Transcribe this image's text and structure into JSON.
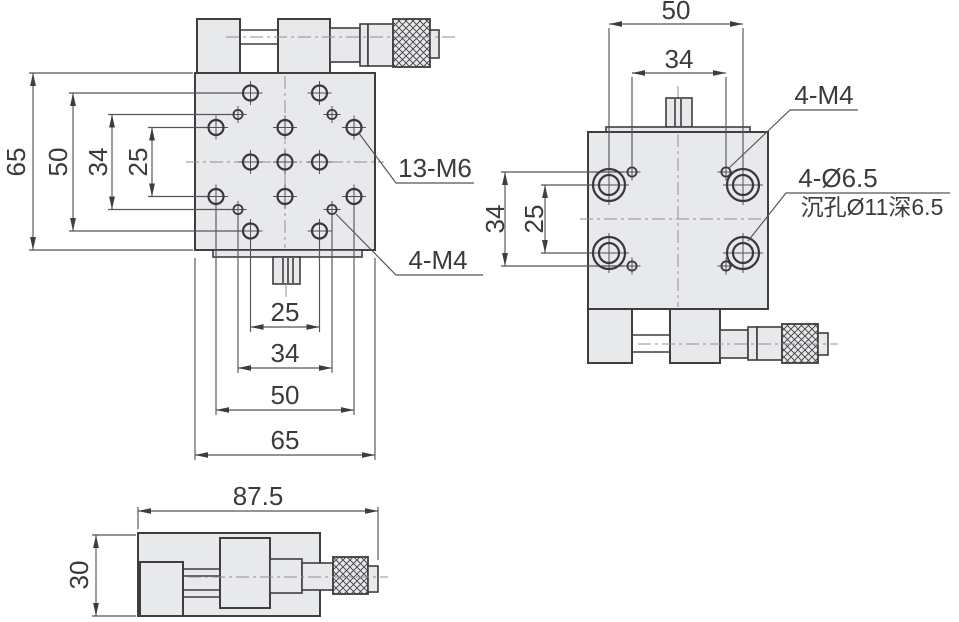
{
  "title": "XY translation stage dimensional drawing",
  "colors": {
    "part_fill": "#e8e9ea",
    "object_line": "#3e3e40",
    "dimension_line": "#55555a",
    "center_line": "#909093",
    "text": "#3b3b3d",
    "background": "#ffffff"
  },
  "views": {
    "top_view": {
      "dim_left": {
        "d65": "65",
        "d50": "50",
        "d34": "34",
        "d25": "25"
      },
      "dim_bottom": {
        "d25": "25",
        "d34": "34",
        "d50": "50",
        "d65": "65"
      },
      "leader_m6": "13-M6",
      "leader_m4": "4-M4"
    },
    "bottom_view": {
      "dim_top": {
        "d50": "50",
        "d34": "34"
      },
      "dim_left": {
        "d34": "34",
        "d25": "25"
      },
      "leader_m4": "4-M4",
      "leader_counterbore_line1": "4-Ø6.5",
      "leader_counterbore_line2": "沉孔Ø11深6.5"
    },
    "side_view": {
      "dim_width": "87.5",
      "dim_height": "30"
    }
  }
}
